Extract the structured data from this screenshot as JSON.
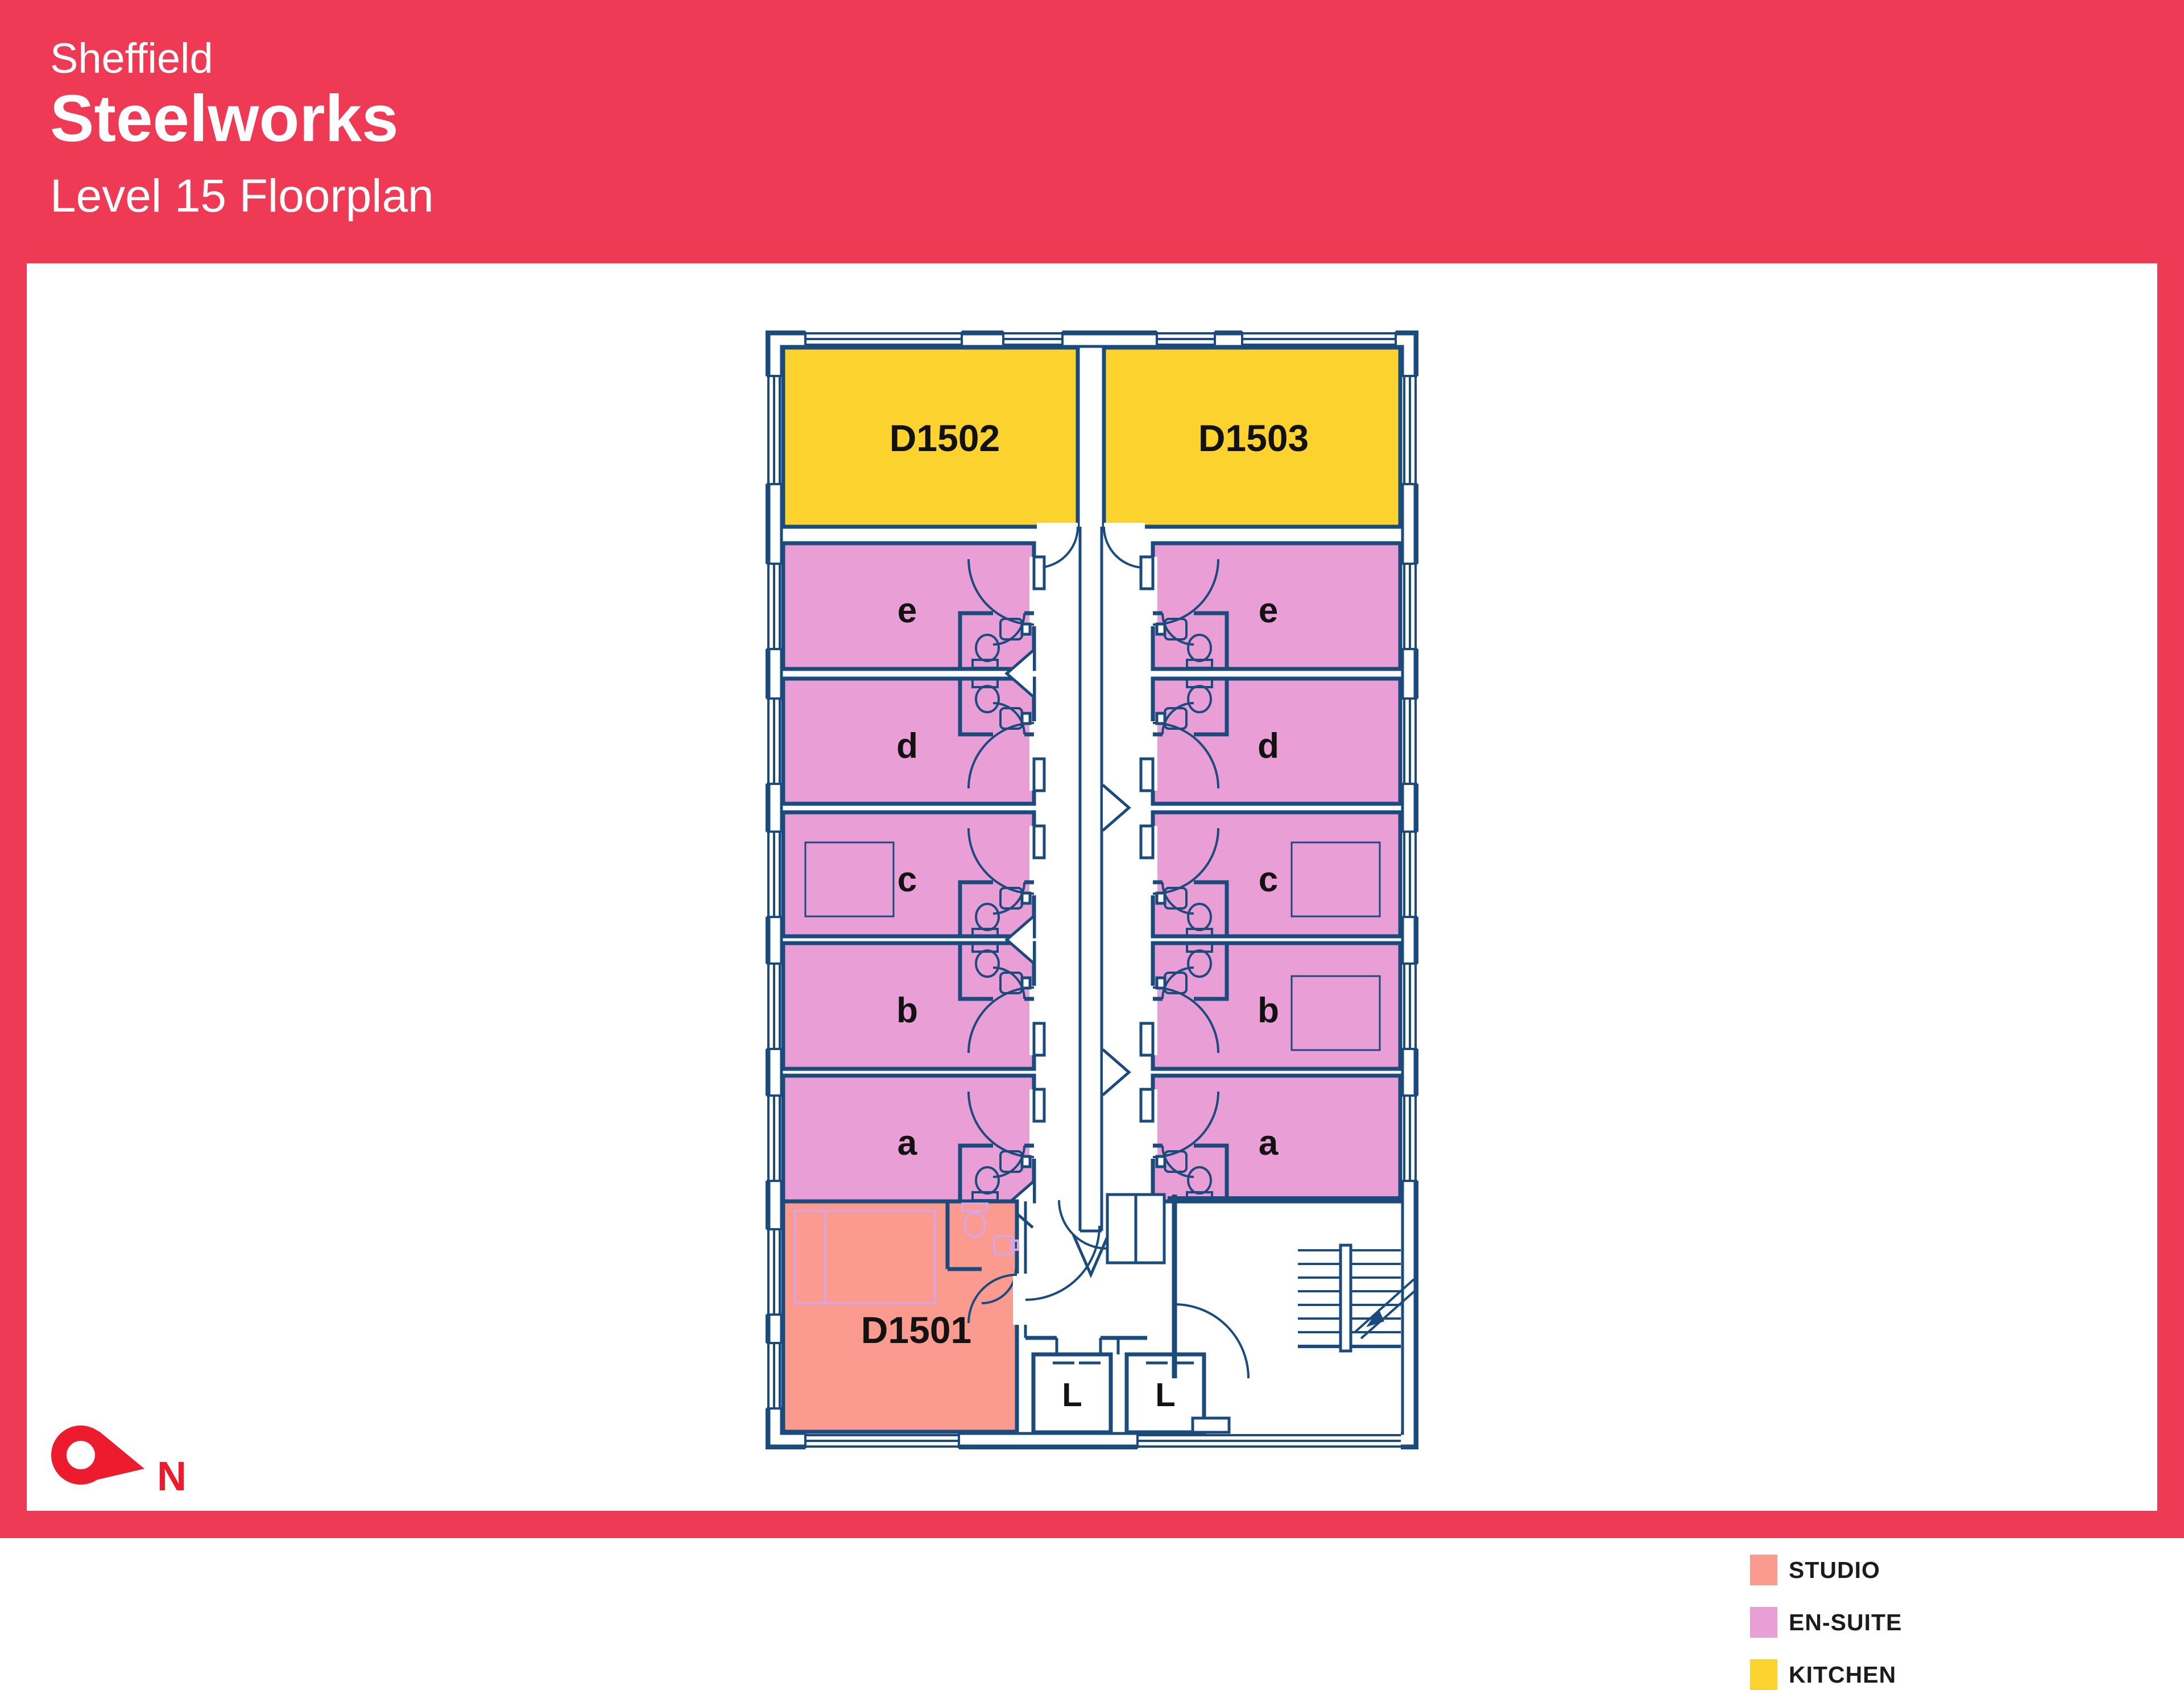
{
  "header": {
    "city": "Sheffield",
    "building": "Steelworks",
    "subtitle": "Level 15 Floorplan"
  },
  "colors": {
    "brand_red": "#EF3A56",
    "compass_red": "#EC1B2E",
    "wall_navy": "#1B4B7D",
    "studio": "#FB9B90",
    "en_suite": "#E99ED6",
    "kitchen": "#FBD22E",
    "fixture_pink": "#D9A4DF",
    "label_black": "#121212"
  },
  "floorplan": {
    "kitchens": [
      {
        "label": "D1502"
      },
      {
        "label": "D1503"
      }
    ],
    "studio": {
      "label": "D1501"
    },
    "en_suite_letters": [
      "e",
      "d",
      "c",
      "b",
      "a"
    ],
    "lifts": [
      {
        "label": "L"
      },
      {
        "label": "L"
      }
    ]
  },
  "legend": {
    "items": [
      {
        "label": "STUDIO",
        "color": "#FB9B90"
      },
      {
        "label": "EN-SUITE",
        "color": "#E99ED6"
      },
      {
        "label": "KITCHEN",
        "color": "#FBD22E"
      }
    ]
  },
  "compass": {
    "label": "N"
  }
}
